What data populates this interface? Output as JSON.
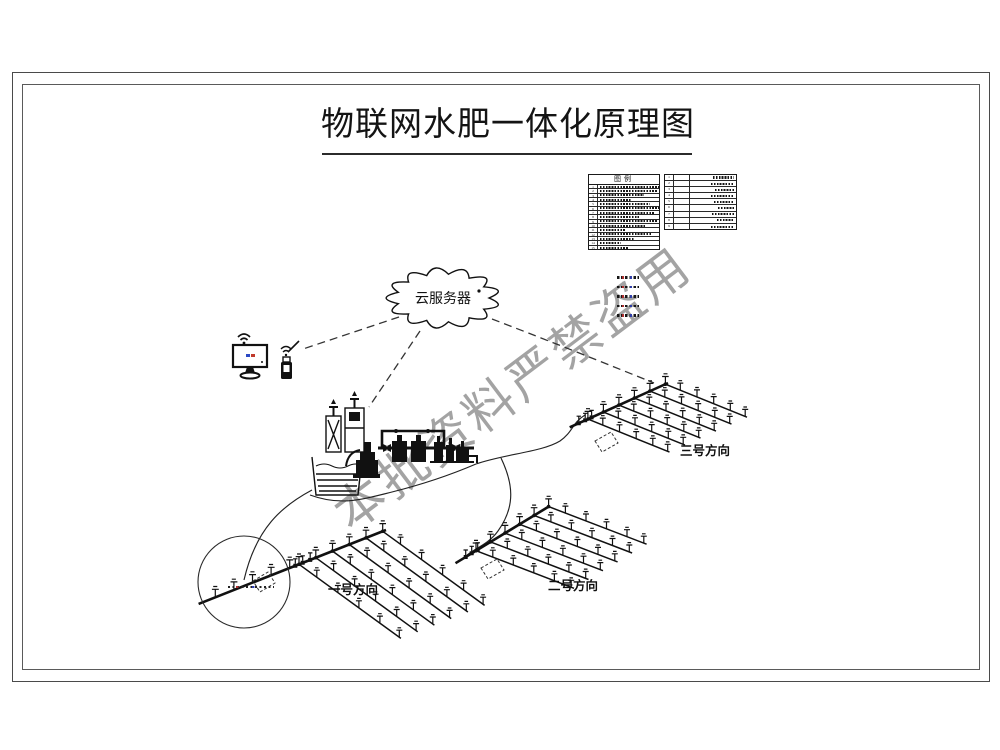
{
  "title": "物联网水肥一体化原理图",
  "watermark": "本批资料严禁盗用",
  "cloud": {
    "label": "云服务器"
  },
  "legend": {
    "title": "图例",
    "left_rows": [
      "1",
      "2",
      "3",
      "4",
      "5",
      "6",
      "7",
      "8",
      "9",
      "10",
      "11",
      "12",
      "13",
      "14",
      "15"
    ],
    "right_rows": [
      "1",
      "2",
      "3",
      "4",
      "5",
      "6",
      "7",
      "8",
      "9"
    ],
    "note_dash_count": 5
  },
  "fields": [
    {
      "label": "一号方向"
    },
    {
      "label": "二号方向"
    },
    {
      "label": "三号方向"
    }
  ],
  "colors": {
    "line": "#111111",
    "watermark_gray": "#8f8f8f",
    "screen_blue": "#2b49c4",
    "screen_red": "#c0392b"
  }
}
